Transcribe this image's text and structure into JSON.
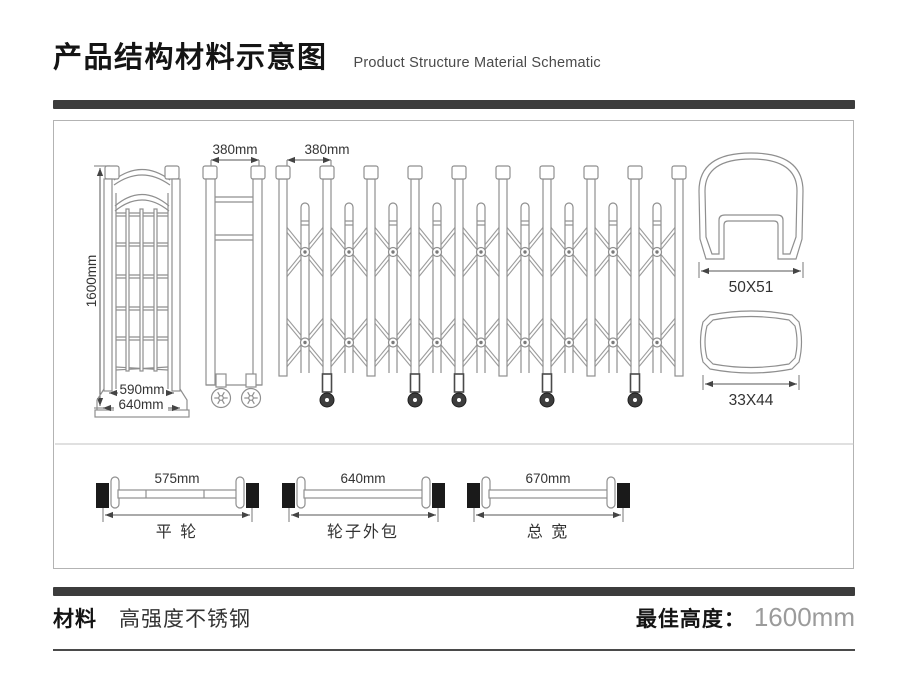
{
  "header": {
    "title_zh": "产品结构材料示意图",
    "title_en": "Product Structure Material Schematic"
  },
  "diagram": {
    "folded_gate": {
      "height": "1600mm",
      "inner_width": "590mm",
      "outer_width": "640mm"
    },
    "closed_unit": {
      "width": "380mm"
    },
    "extended_unit": {
      "pitch": "380mm"
    },
    "profiles": {
      "main_rail": "50X51",
      "cross_tube": "33X44"
    },
    "axles": [
      {
        "dim": "575mm",
        "label": "平 轮"
      },
      {
        "dim": "640mm",
        "label": "轮子外包"
      },
      {
        "dim": "670mm",
        "label": "总 宽"
      }
    ]
  },
  "footer": {
    "material_label": "材料",
    "material_value": "高强度不锈钢",
    "best_height_label": "最佳高度：",
    "best_height_value": "1600mm"
  },
  "colors": {
    "divider_bar": "#3c3c3c",
    "drawing_line": "#8f8f8f",
    "dimension_text": "#333333",
    "muted_value": "#9b9b9b"
  }
}
